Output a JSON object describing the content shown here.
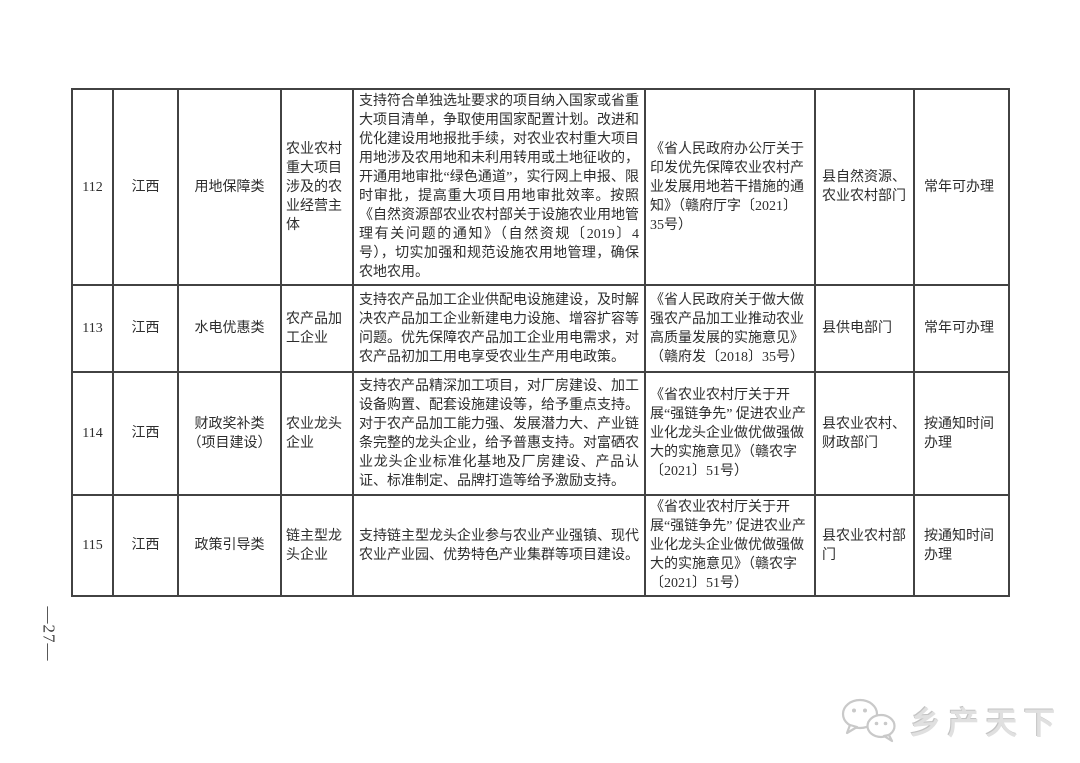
{
  "page": {
    "page_number": "—27—",
    "watermark": {
      "brand_text": "乡产天下",
      "icon": "chat-bubbles-icon",
      "icon_color": "#c9c9c9",
      "text_color": "#e0e0e0"
    }
  },
  "colors": {
    "table_border": "#424242",
    "text": "#2d2d2d",
    "background": "#ffffff"
  },
  "table": {
    "rows": [
      {
        "seq": "112",
        "province": "江西",
        "category": "用地保障类",
        "target": "农业农村重大项目涉及的农业经营主体",
        "measure": "支持符合单独选址要求的项目纳入国家或省重大项目清单，争取使用国家配置计划。改进和优化建设用地报批手续，对农业农村重大项目用地涉及农用地和未利用转用或土地征收的，开通用地审批“绿色通道”，实行网上申报、限时审批，提高重大项目用地审批效率。按照《自然资源部农业农村部关于设施农业用地管理有关问题的通知》（自然资规〔2019〕4号），切实加强和规范设施农用地管理，确保农地农用。",
        "policy_basis": "《省人民政府办公厅关于印发优先保障农业农村产业发展用地若干措施的通知》（赣府厅字〔2021〕35号）",
        "department": "县自然资源、农业农村部门",
        "handle_time": "常年可办理"
      },
      {
        "seq": "113",
        "province": "江西",
        "category": "水电优惠类",
        "target": "农产品加工企业",
        "measure": "支持农产品加工企业供配电设施建设，及时解决农产品加工企业新建电力设施、增容扩容等问题。优先保障农产品加工企业用电需求，对农产品初加工用电享受农业生产用电政策。",
        "policy_basis": "《省人民政府关于做大做强农产品加工业推动农业高质量发展的实施意见》（赣府发〔2018〕35号）",
        "department": "县供电部门",
        "handle_time": "常年可办理"
      },
      {
        "seq": "114",
        "province": "江西",
        "category": "财政奖补类\n（项目建设）",
        "target": "农业龙头企业",
        "measure": "支持农产品精深加工项目，对厂房建设、加工设备购置、配套设施建设等，给予重点支持。对于农产品加工能力强、发展潜力大、产业链条完整的龙头企业，给予普惠支持。对富硒农业龙头企业标准化基地及厂房建设、产品认证、标准制定、品牌打造等给予激励支持。",
        "policy_basis": "《省农业农村厅关于开展“强链争先” 促进农业产业化龙头企业做优做强做大的实施意见》（赣农字〔2021〕51号）",
        "department": "县农业农村、财政部门",
        "handle_time": "按通知时间办理"
      },
      {
        "seq": "115",
        "province": "江西",
        "category": "政策引导类",
        "target": "链主型龙头企业",
        "measure": "支持链主型龙头企业参与农业产业强镇、现代农业产业园、优势特色产业集群等项目建设。",
        "policy_basis": "《省农业农村厅关于开展“强链争先” 促进农业产业化龙头企业做优做强做大的实施意见》（赣农字〔2021〕51号）",
        "department": "县农业农村部门",
        "handle_time": "按通知时间办理"
      }
    ]
  }
}
